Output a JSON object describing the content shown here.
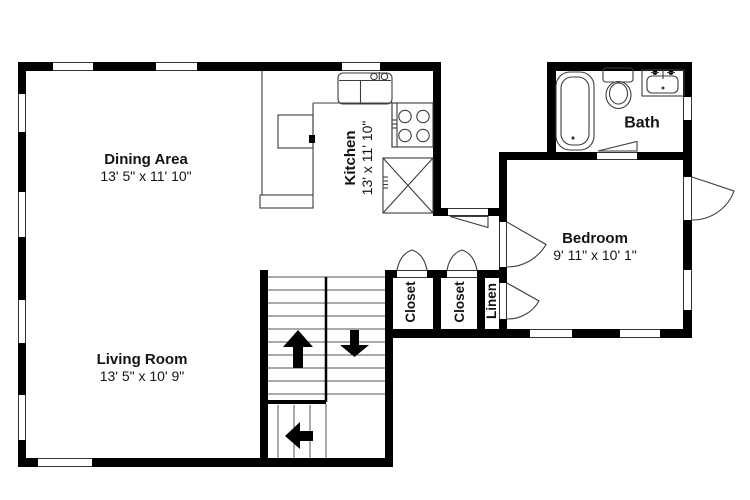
{
  "rooms": {
    "dining": {
      "name": "Dining Area",
      "dims": "13' 5\" x 11' 10\""
    },
    "kitchen": {
      "name": "Kitchen",
      "dims": "13' x 11' 10\""
    },
    "living": {
      "name": "Living Room",
      "dims": "13' 5\" x 10' 9\""
    },
    "bedroom": {
      "name": "Bedroom",
      "dims": "9' 11\" x 10' 1\""
    },
    "bath": {
      "name": "Bath"
    },
    "closet_a": {
      "name": "Closet"
    },
    "closet_b": {
      "name": "Closet"
    },
    "linen": {
      "name": "Linen"
    }
  },
  "fixtures": [
    "bathtub",
    "toilet",
    "bathroom-sink",
    "kitchen-sink",
    "stove",
    "refrigerator",
    "kitchen-counter"
  ],
  "stairs": {
    "arrow_directions": [
      "up",
      "down",
      "left"
    ]
  },
  "colors": {
    "wall": "#000000",
    "background": "#ffffff",
    "thin_line": "#3c3c3c"
  }
}
